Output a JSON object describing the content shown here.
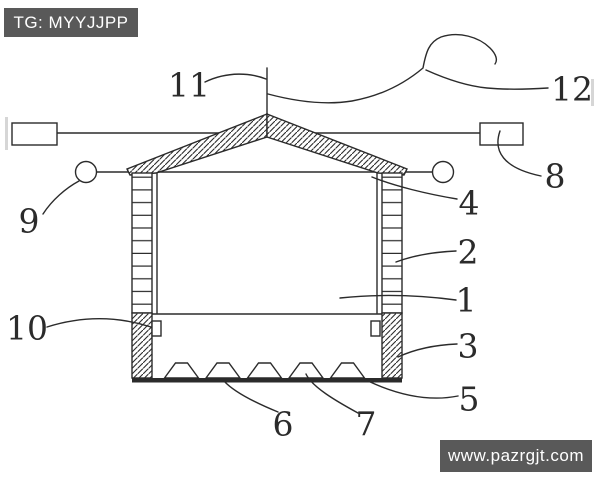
{
  "colors": {
    "background": "#ffffff",
    "line": "#2b2b2b",
    "watermark_bg": "#595959",
    "watermark_text": "#ffffff"
  },
  "watermarks": {
    "top_left": "TG: MYYJJPP",
    "bottom_right": "www.pazrgjt.com"
  },
  "figure": {
    "kind": "patent line drawing: gabled shelter section with hatched roof, ladder-pattern walls, hatched base, serrated bottom plate, anchor rods and hooked cable",
    "labels": [
      {
        "text": "1",
        "refers_to": "inner chamber"
      },
      {
        "text": "2",
        "refers_to": "right wall"
      },
      {
        "text": "3",
        "refers_to": "right base block"
      },
      {
        "text": "4",
        "refers_to": "wall-top / eave joint"
      },
      {
        "text": "5",
        "refers_to": "bottom plate edge"
      },
      {
        "text": "6",
        "refers_to": "bottom plate between teeth"
      },
      {
        "text": "7",
        "refers_to": "serration tooth"
      },
      {
        "text": "8",
        "refers_to": "right anchor block"
      },
      {
        "text": "9",
        "refers_to": "left eye ring"
      },
      {
        "text": "10",
        "refers_to": "inner wall block"
      },
      {
        "text": "11",
        "refers_to": "top pole"
      },
      {
        "text": "12",
        "refers_to": "hooked cable"
      }
    ]
  }
}
